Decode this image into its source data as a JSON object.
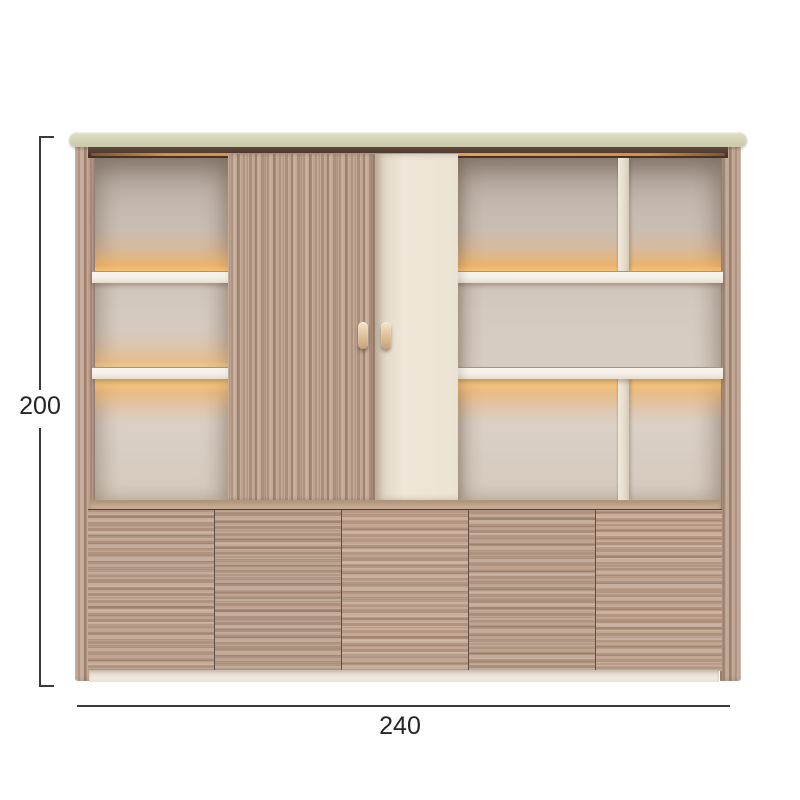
{
  "meta": {
    "title": "Cabinet dimension diagram"
  },
  "dimensions": {
    "height": "200",
    "width": "240"
  },
  "product": {
    "name": "wall-unit-display-cabinet",
    "upper_shelf_rows": 3,
    "lower_door_columns": 5,
    "sliding_doors": [
      "wood",
      "cream"
    ]
  },
  "colors": {
    "background": "#ffffff",
    "dimension_line": "#3a3a3a",
    "dimension_text": "#242424",
    "wood": "#b79c8a",
    "cream_door": "#ece3d4",
    "top_panel": "#d7d5b8",
    "interior_back": "#d5cac0",
    "shelf": "#f3eee6",
    "led_glow": "#f4a446",
    "plinth": "#f2eadf"
  }
}
